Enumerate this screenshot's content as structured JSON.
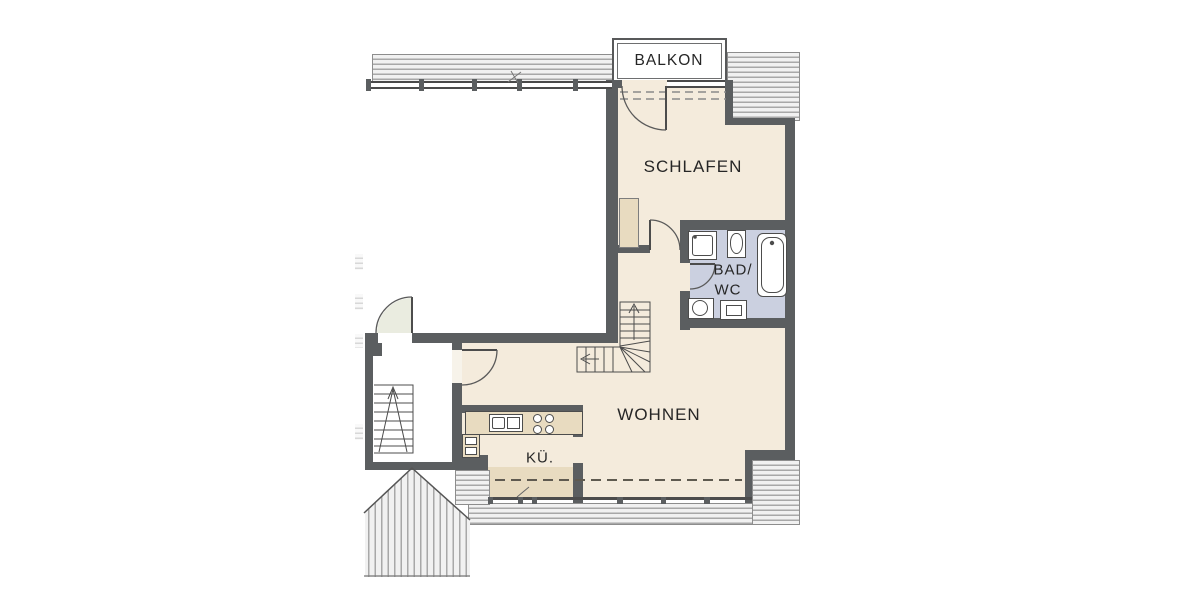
{
  "labels": {
    "balcony": "BALKON",
    "bedroom": "SCHLAFEN",
    "bath_line1": "BAD/",
    "bath_line2": "WC",
    "living": "WOHNEN",
    "kitchen": "KÜ."
  },
  "colors": {
    "floor-beige": "#f4ebdc",
    "floor-tan": "#e8dbc0",
    "bath-blue": "#cbd0e0",
    "wall-dark": "#5b5e60",
    "line-dark": "#4c4c4c",
    "hatch-bg": "#f1f1f1",
    "hatch-line": "#a8a8a8",
    "label-color": "#262626",
    "entry-tint": "#eaece0"
  },
  "fixtures": [
    "shower",
    "washbasin",
    "bathtub",
    "wc",
    "washing-machine",
    "kitchen-counter",
    "kitchen-sink",
    "cooktop",
    "oven-unit",
    "wardrobe",
    "winder-staircase",
    "building-staircase",
    "entrance-door",
    "interior-door",
    "bedroom-door",
    "bathroom-door",
    "balcony-door",
    "roof-hatching",
    "gable-roof",
    "roof-slope-dashed-lines"
  ]
}
